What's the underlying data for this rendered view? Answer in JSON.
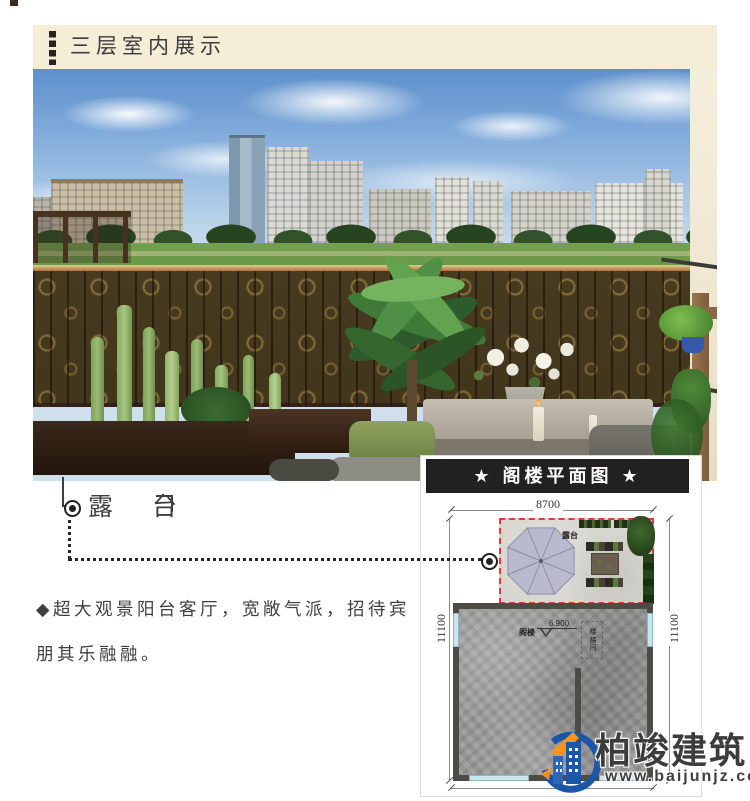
{
  "header": {
    "title": "三层室内展示"
  },
  "photo": {
    "callout_label": "露 台"
  },
  "description": {
    "line1": "◆超大观景阳台客厅，宽敞气派，招待宾",
    "line2": "朋其乐融融。"
  },
  "floorplan": {
    "title": "★ 阁楼平面图 ★",
    "dim_top": "8700",
    "dim_left": "11100",
    "dim_right": "11100",
    "terrace_label": "露台",
    "attic_label": "阁楼",
    "level_label": "6.900",
    "stair_label": "楼梯间"
  },
  "logo": {
    "name": "柏竣建筑",
    "url": "www.baijunjz.com"
  },
  "colors": {
    "header_band": "#f5edd6",
    "title_bar": "#222020",
    "terrace_outline": "#e03a3a",
    "umbrella": "#b9bacd",
    "logo_blue": "#1b57a6",
    "logo_orange": "#f7941d"
  },
  "icons": {
    "accent_bar": "dashed-vertical-bar",
    "title_stars": "star",
    "description_bullet": "diamond",
    "leader_markers": "bullseye-circle",
    "umbrella": "umbrella-top-view",
    "logo_mark": "building-with-swoosh"
  }
}
